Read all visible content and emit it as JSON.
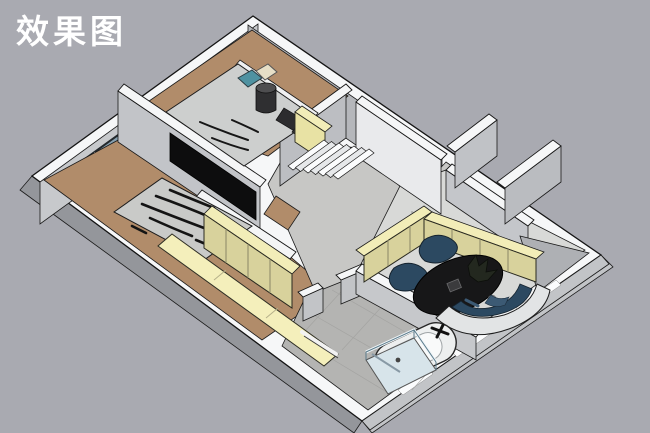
{
  "header": {
    "title": "效果图"
  },
  "palette": {
    "background": "#a9aab1",
    "slab_side": "#94969b",
    "slab_side_light": "#c2c4c7",
    "wall_top": "#f6f7f8",
    "wall_face_light": "#c7c9cc",
    "wall_face_medium": "#b5b7bb",
    "wall_face_inner": "#c2c4c8",
    "wall_face_bright": "#e9eaec",
    "floor_wood": "#b18c6a",
    "floor_concrete": "#c7c7c5",
    "floor_terrazzo": "#d8d9d7",
    "floor_tile": "#b4b4b2",
    "cabinet_top_yellow": "#f2edb8",
    "cabinet_front_olive": "#d8d29c",
    "bench_yellow": "#f4efbb",
    "furniture_navy": "#2c4961",
    "bed_gray": "#c9cac8",
    "bed_gray_light": "#cdcfce",
    "tv_black": "#0d0d0e",
    "rug_black": "#171718",
    "window_glass": "#87a0af",
    "shower_glass": "#d7e4ea",
    "pillow_teal": "#4f92a1",
    "pillow_cream": "#e7dfc6",
    "tub_white": "#edefef",
    "outline": "#141414"
  },
  "scene": {
    "type": "3d-floorplan-render",
    "rooms": [
      {
        "name": "bedroom-top"
      },
      {
        "name": "bedroom-left"
      },
      {
        "name": "stair-hall"
      },
      {
        "name": "corridor"
      },
      {
        "name": "living-study-room"
      },
      {
        "name": "bathroom"
      },
      {
        "name": "entry"
      }
    ],
    "furniture": [
      {
        "name": "bed-top"
      },
      {
        "name": "bed-left"
      },
      {
        "name": "tv-panel"
      },
      {
        "name": "wardrobe"
      },
      {
        "name": "low-bench"
      },
      {
        "name": "staircase"
      },
      {
        "name": "hall-cabinet"
      },
      {
        "name": "living-cabinets"
      },
      {
        "name": "lounge-chairs"
      },
      {
        "name": "round-rug"
      },
      {
        "name": "curved-sofa"
      },
      {
        "name": "bathtub"
      },
      {
        "name": "shower-enclosure"
      },
      {
        "name": "towel-bar"
      }
    ]
  }
}
